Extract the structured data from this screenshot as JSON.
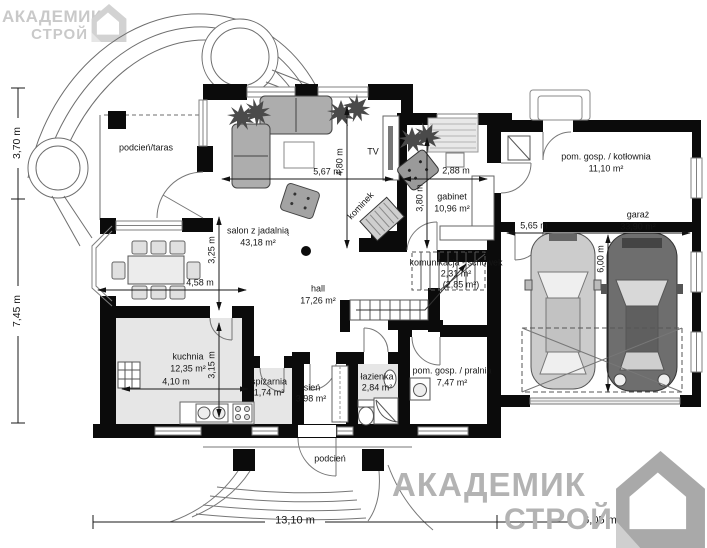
{
  "watermark": {
    "line1": "АКАДЕМИК",
    "line2": "СТРОЙ"
  },
  "rooms": {
    "taras": {
      "name": "podcień/taras"
    },
    "salon": {
      "name": "salon z jadalnią",
      "area": "43,18 m²"
    },
    "hall": {
      "name": "hall",
      "area": "17,26 m²"
    },
    "kuchnia": {
      "name": "kuchnia",
      "area": "12,35 m²"
    },
    "spizarnia": {
      "name": "spiżarnia",
      "area": "1,74 m²"
    },
    "sien": {
      "name": "sień",
      "area": "3,98 m²"
    },
    "lazienka": {
      "name": "łazienka",
      "area": "2,84 m²"
    },
    "pralnia": {
      "name": "pom. gosp. / pralnia",
      "area": "7,47 m²"
    },
    "gabinet": {
      "name": "gabinet",
      "area": "10,96 m²"
    },
    "komunikacja": {
      "name": "komunikacja - schowek",
      "area": "2,31 m²",
      "area_alt": "(2,85 m²)"
    },
    "kotlownia": {
      "name": "pom. gosp. / kotłownia",
      "area": "11,10 m²"
    },
    "garaz": {
      "name": "garaż",
      "area": "33,90 m²"
    },
    "podcien": {
      "name": "podcień"
    }
  },
  "features": {
    "tv": "TV",
    "kominek": "kominek"
  },
  "dimensions": {
    "left_top": "3,70 m",
    "left_bottom": "7,45 m",
    "bottom_main": "13,10 m",
    "bottom_garage": "6,05 m",
    "salon_w": "5,67 m",
    "salon_h": "4,80 m",
    "jadalnia_w": "4,58 m",
    "jadalnia_h": "3,25 m",
    "kuchnia_w": "4,10 m",
    "kuchnia_h": "3,15 m",
    "gabinet_w": "2,88 m",
    "gabinet_h": "3,80 m",
    "garaz_w": "5,65 m",
    "garaz_h": "6,00 m"
  },
  "colors": {
    "wall": "#0b0b0b",
    "floor_gray": "#e6e6e6",
    "dim_line": "#1a1a1a",
    "watermark": "#b3b3b3"
  }
}
